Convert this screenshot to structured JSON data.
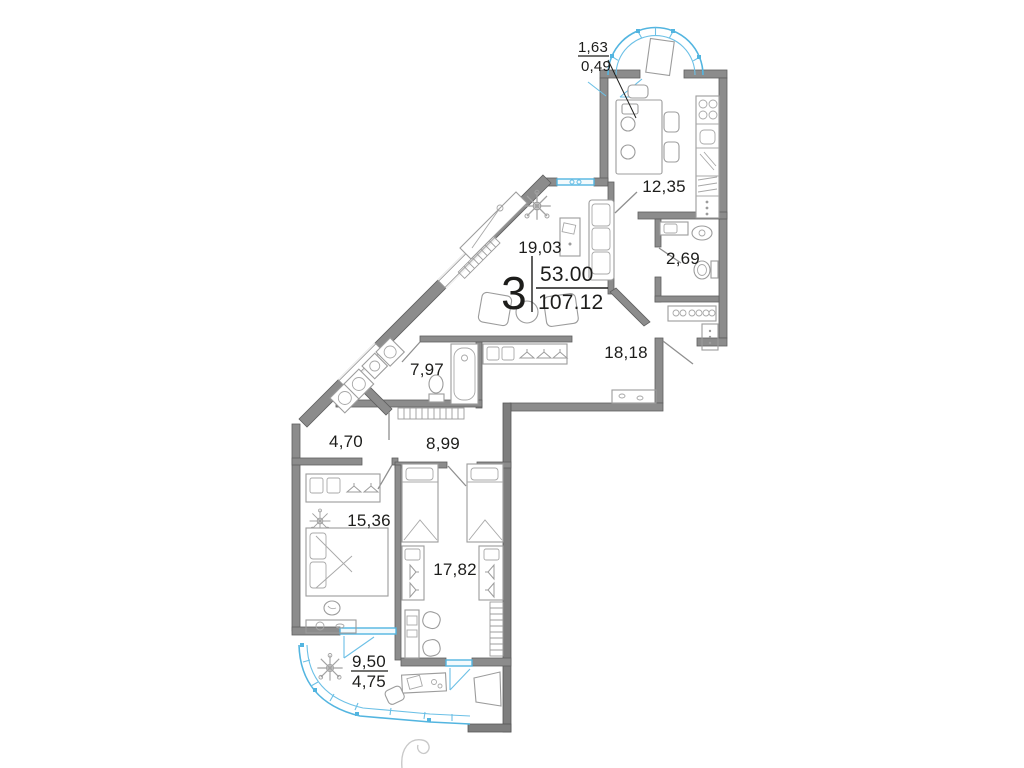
{
  "plan_type": "apartment floor plan",
  "summary": {
    "rooms_count": "3",
    "living_area": "53.00",
    "total_area": "107.12"
  },
  "balconies": {
    "top_full": "1,63",
    "top_reduced": "0,49",
    "bottom_full": "9,50",
    "bottom_reduced": "4,75"
  },
  "rooms": {
    "kitchen": "12,35",
    "wc": "2,69",
    "living": "19,03",
    "hall": "18,18",
    "bathroom": "7,97",
    "laundry": "4,70",
    "corridor": "8,99",
    "bedroom": "15,36",
    "kids": "17,82"
  },
  "colors": {
    "wall": "#8c8c8c",
    "wall_stroke": "#5f5f5f",
    "glazing": "#53b5e0",
    "furniture": "#9c9c9c",
    "text": "#1d1d1b",
    "background": "#ffffff"
  }
}
